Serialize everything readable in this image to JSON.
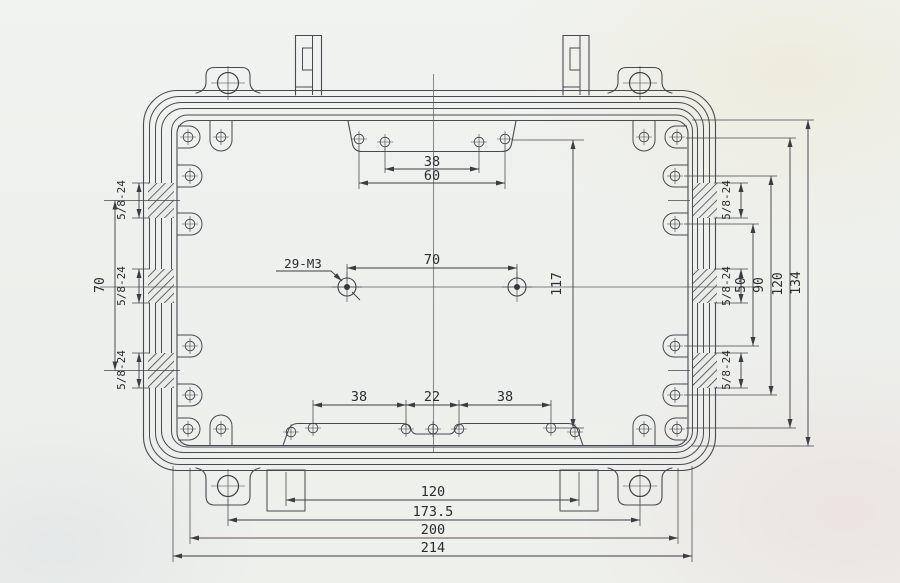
{
  "drawing": {
    "kind": "technical-drawing",
    "callouts": {
      "mounting": "29-M3",
      "port": "5/8-24"
    },
    "dims": {
      "top_inner": "38",
      "top_outer": "60",
      "center_span": "70",
      "center_height": "117",
      "left_ports": "70",
      "right_inner": "50",
      "right_mid": "90",
      "right_outer": "120",
      "right_opening": "134",
      "bottom_left": "38",
      "bottom_center": "22",
      "bottom_right": "38",
      "chain_feet": "120",
      "chain_ears": "173.5",
      "chain_body": "200",
      "chain_overall": "214"
    },
    "colors": {
      "paper": "#eef0ec",
      "line": "#474a52",
      "dimension": "#3b3d42",
      "hatch": "#3a3c41",
      "text": "#2b2c30"
    }
  }
}
